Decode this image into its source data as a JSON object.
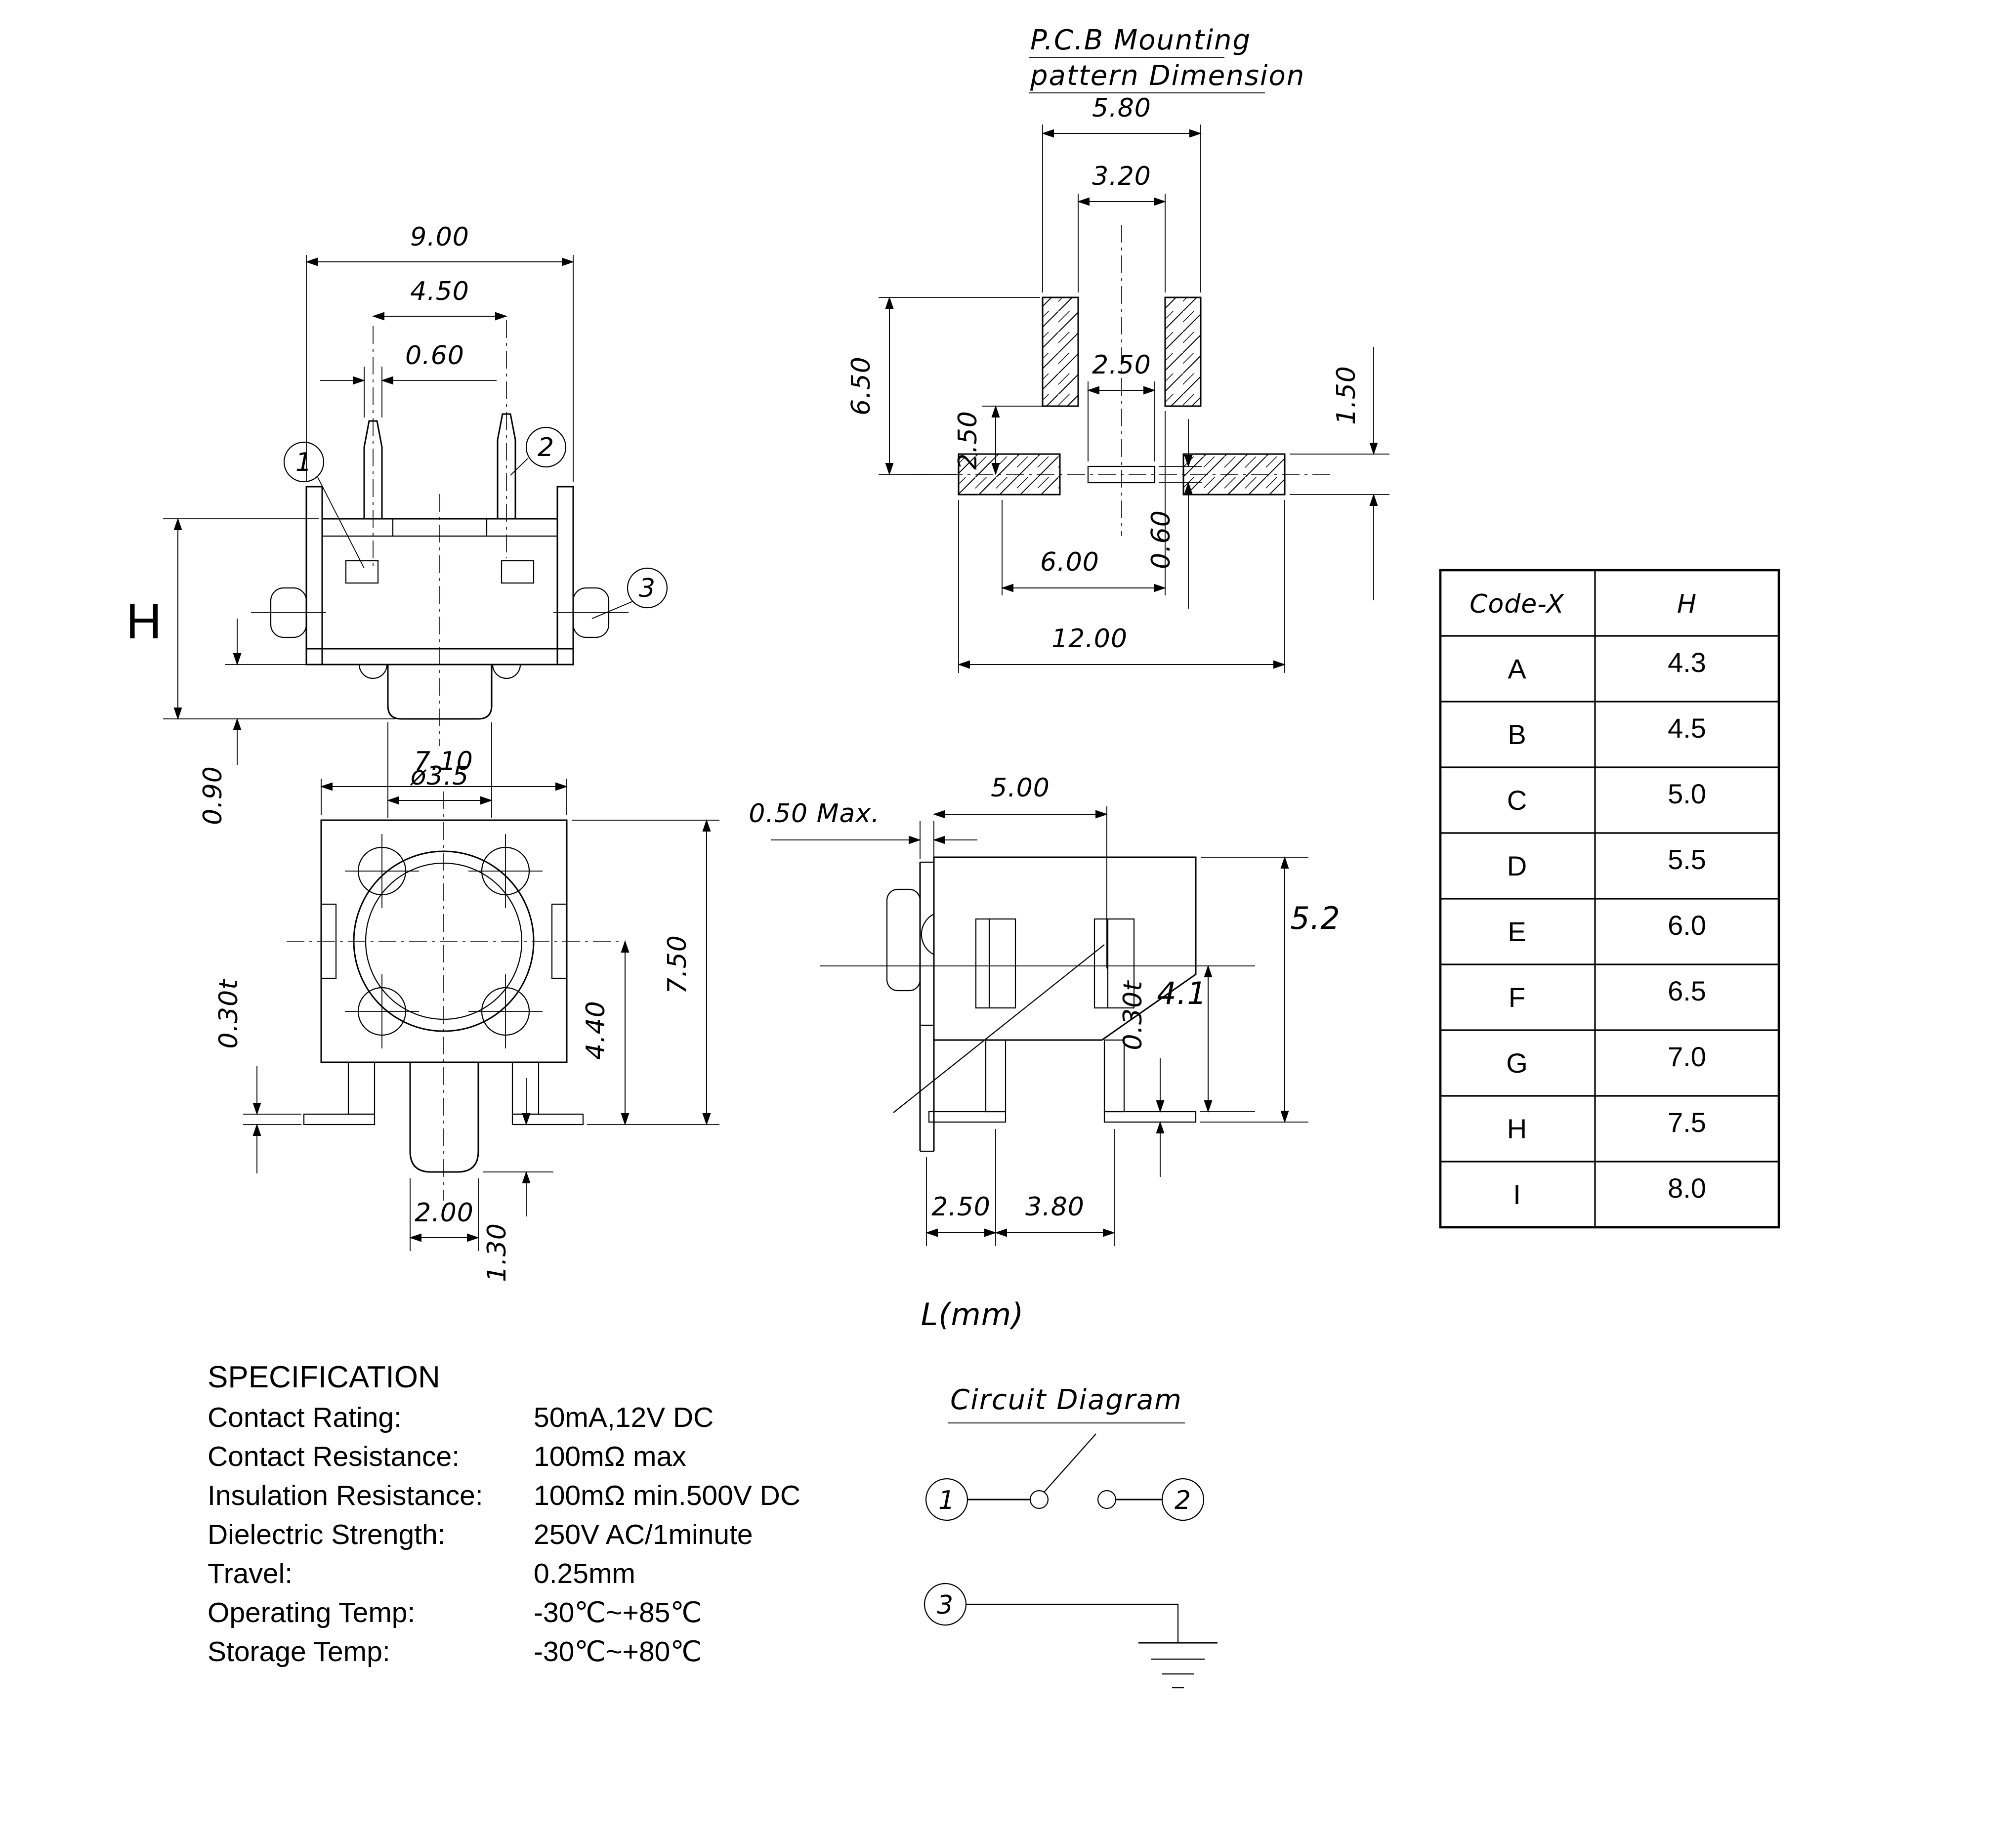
{
  "page": {
    "background": "#ffffff",
    "line_color": "#000000"
  },
  "pcb_view": {
    "title_line1": "P.C.B Mounting",
    "title_line2": "pattern Dimension",
    "dims": {
      "pad_span_outer": "5.80",
      "pad_span_inner": "3.20",
      "pad_height": "6.50",
      "pad_offset": "2.50",
      "side_pad_height": "1.50",
      "slot_width": "2.50",
      "slot_height": "0.60",
      "half_span": "6.00",
      "total_span": "12.00"
    }
  },
  "front_view": {
    "dims": {
      "overall_width": "9.00",
      "pin_pitch": "4.50",
      "pin_width": "0.60",
      "body_height": "H",
      "standoff": "0.90",
      "shaft_dia": "ø3.5"
    },
    "pin_labels": {
      "pin1": "1",
      "pin2": "2",
      "pin3": "3"
    }
  },
  "top_view": {
    "dims": {
      "body_width": "7.10",
      "metal_thickness": "0.30t",
      "overall_height": "7.50",
      "leg_span": "4.40",
      "stub_width": "2.00",
      "stub_depth": "1.30"
    }
  },
  "side_view": {
    "dims": {
      "clearance": "0.50 Max.",
      "body_width": "5.00",
      "overall_height": "5.2",
      "leg_height": "4.1",
      "metal_thickness": "0.30t",
      "pitch_a": "2.50",
      "pitch_b": "3.80"
    },
    "unit_label": "L(mm)"
  },
  "code_table": {
    "headers": {
      "col1": "Code-X",
      "col2": "H"
    },
    "rows": [
      {
        "code": "A",
        "h": "4.3"
      },
      {
        "code": "B",
        "h": "4.5"
      },
      {
        "code": "C",
        "h": "5.0"
      },
      {
        "code": "D",
        "h": "5.5"
      },
      {
        "code": "E",
        "h": "6.0"
      },
      {
        "code": "F",
        "h": "6.5"
      },
      {
        "code": "G",
        "h": "7.0"
      },
      {
        "code": "H",
        "h": "7.5"
      },
      {
        "code": "I",
        "h": "8.0"
      }
    ]
  },
  "specification": {
    "title": "SPECIFICATION",
    "items": [
      {
        "label": "Contact Rating:",
        "value": "50mA,12V DC"
      },
      {
        "label": "Contact Resistance:",
        "value": "100mΩ max"
      },
      {
        "label": "Insulation Resistance:",
        "value": "100mΩ min.500V DC"
      },
      {
        "label": "Dielectric Strength:",
        "value": "250V AC/1minute"
      },
      {
        "label": "Travel:",
        "value": "0.25mm"
      },
      {
        "label": "Operating Temp:",
        "value": "-30℃~+85℃"
      },
      {
        "label": "Storage Temp:",
        "value": "-30℃~+80℃"
      }
    ]
  },
  "circuit": {
    "title": "Circuit Diagram",
    "terminals": {
      "t1": "1",
      "t2": "2",
      "t3": "3"
    }
  }
}
